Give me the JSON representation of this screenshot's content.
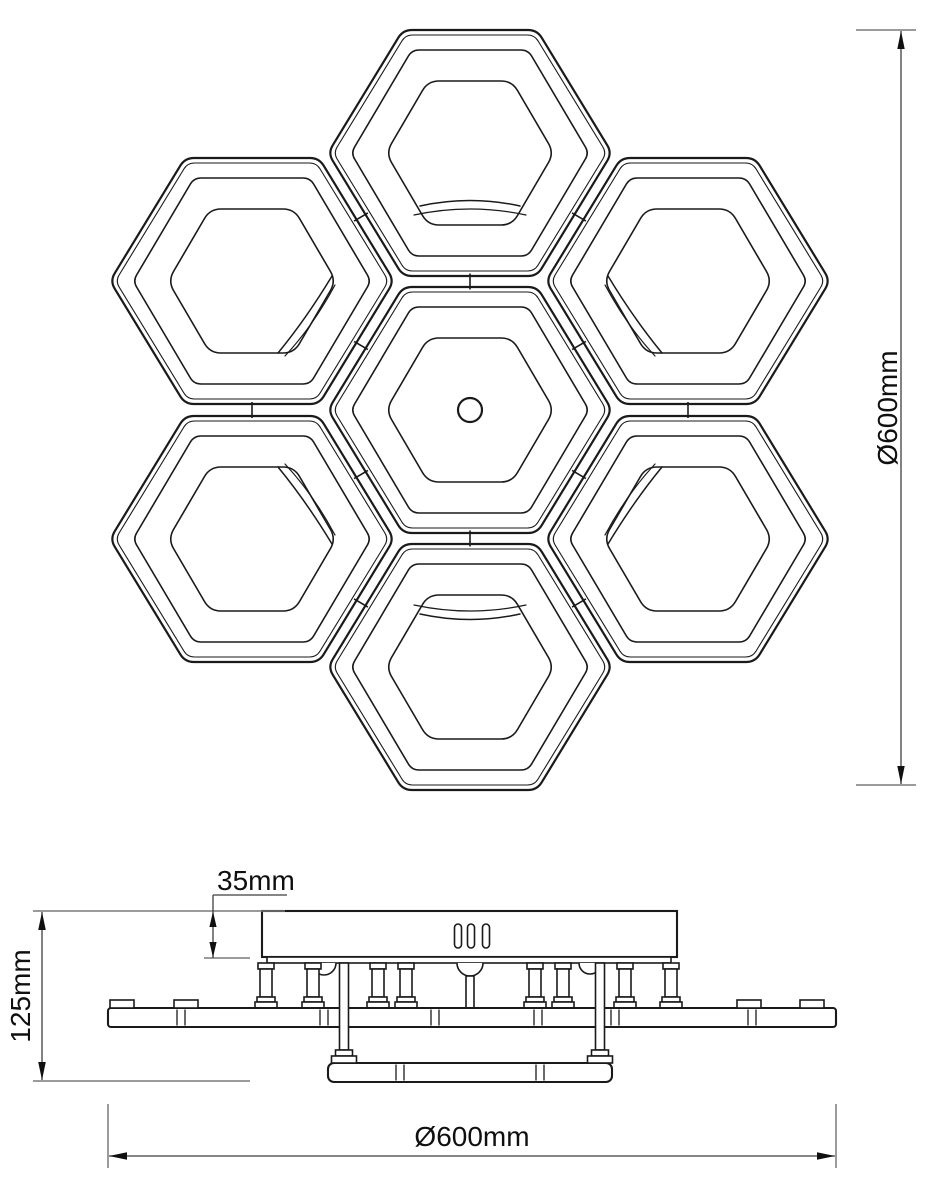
{
  "drawing": {
    "background": "#ffffff",
    "line_color": "#1a1a1a",
    "dimension_line_color": "#3f3f3f",
    "extension_tick_color": "#7a7a7a",
    "text_color": "#0f0f0f"
  },
  "dimensions": {
    "overall_height": {
      "label": "Ø600mm"
    },
    "overall_width": {
      "label": "Ø600mm"
    },
    "fixture_height": {
      "label": "125mm"
    },
    "canopy_thickness": {
      "label": "35mm"
    }
  }
}
